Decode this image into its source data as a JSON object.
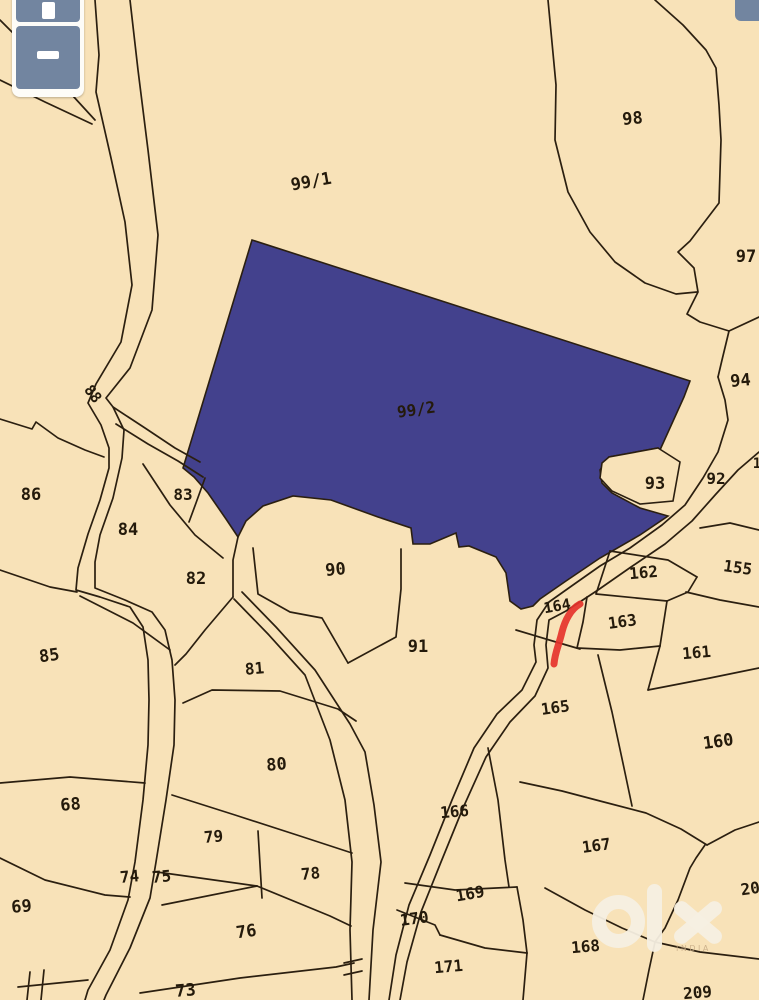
{
  "map": {
    "background_color": "#f8e2b8",
    "line_color": "#2b1f10",
    "highlight_parcel": {
      "label": "99/2",
      "fill": "#43418d",
      "label_color": "#23215f",
      "x": 417,
      "y": 415,
      "rotation": -8,
      "size": 16
    },
    "annotation": {
      "name": "red-marker-stroke",
      "color": "#e5332b"
    },
    "parcel_labels": [
      {
        "t": "98",
        "x": 633,
        "y": 124,
        "r": -5,
        "s": 17
      },
      {
        "t": "99/1",
        "x": 312,
        "y": 187,
        "r": -10,
        "s": 17
      },
      {
        "t": "97",
        "x": 746,
        "y": 262,
        "r": 0,
        "s": 17
      },
      {
        "t": "94",
        "x": 741,
        "y": 386,
        "r": -5,
        "s": 17
      },
      {
        "t": "92",
        "x": 716,
        "y": 484,
        "r": 0,
        "s": 16
      },
      {
        "t": "93",
        "x": 655,
        "y": 489,
        "r": 0,
        "s": 17
      },
      {
        "t": "1",
        "x": 757,
        "y": 468,
        "r": 0,
        "s": 14
      },
      {
        "t": "155",
        "x": 737,
        "y": 573,
        "r": 8,
        "s": 16
      },
      {
        "t": "86",
        "x": 31,
        "y": 500,
        "r": 0,
        "s": 17
      },
      {
        "t": "88",
        "x": 89,
        "y": 397,
        "r": 52,
        "s": 15
      },
      {
        "t": "83",
        "x": 183,
        "y": 500,
        "r": 0,
        "s": 16
      },
      {
        "t": "84",
        "x": 128,
        "y": 535,
        "r": 0,
        "s": 17
      },
      {
        "t": "82",
        "x": 196,
        "y": 584,
        "r": 0,
        "s": 17
      },
      {
        "t": "90",
        "x": 336,
        "y": 575,
        "r": -5,
        "s": 17
      },
      {
        "t": "85",
        "x": 50,
        "y": 661,
        "r": -8,
        "s": 17
      },
      {
        "t": "81",
        "x": 255,
        "y": 674,
        "r": -5,
        "s": 16
      },
      {
        "t": "91",
        "x": 418,
        "y": 652,
        "r": 0,
        "s": 17
      },
      {
        "t": "162",
        "x": 644,
        "y": 578,
        "r": -5,
        "s": 16
      },
      {
        "t": "164",
        "x": 558,
        "y": 611,
        "r": -10,
        "s": 15
      },
      {
        "t": "163",
        "x": 623,
        "y": 627,
        "r": -8,
        "s": 16
      },
      {
        "t": "161",
        "x": 697,
        "y": 658,
        "r": -5,
        "s": 16
      },
      {
        "t": "165",
        "x": 556,
        "y": 713,
        "r": -8,
        "s": 16
      },
      {
        "t": "160",
        "x": 719,
        "y": 747,
        "r": -8,
        "s": 17
      },
      {
        "t": "68",
        "x": 71,
        "y": 810,
        "r": -5,
        "s": 17
      },
      {
        "t": "80",
        "x": 277,
        "y": 770,
        "r": -5,
        "s": 17
      },
      {
        "t": "79",
        "x": 214,
        "y": 842,
        "r": -5,
        "s": 16
      },
      {
        "t": "78",
        "x": 311,
        "y": 879,
        "r": -5,
        "s": 16
      },
      {
        "t": "74",
        "x": 130,
        "y": 882,
        "r": -5,
        "s": 16
      },
      {
        "t": "75",
        "x": 162,
        "y": 882,
        "r": -5,
        "s": 16
      },
      {
        "t": "69",
        "x": 22,
        "y": 912,
        "r": -5,
        "s": 17
      },
      {
        "t": "76",
        "x": 247,
        "y": 937,
        "r": -8,
        "s": 17
      },
      {
        "t": "73",
        "x": 186,
        "y": 996,
        "r": -5,
        "s": 17
      },
      {
        "t": "166",
        "x": 455,
        "y": 817,
        "r": -5,
        "s": 16
      },
      {
        "t": "167",
        "x": 597,
        "y": 851,
        "r": -8,
        "s": 16
      },
      {
        "t": "169",
        "x": 471,
        "y": 899,
        "r": -10,
        "s": 16
      },
      {
        "t": "170",
        "x": 415,
        "y": 924,
        "r": -8,
        "s": 16
      },
      {
        "t": "168",
        "x": 586,
        "y": 952,
        "r": -5,
        "s": 16
      },
      {
        "t": "171",
        "x": 449,
        "y": 972,
        "r": -5,
        "s": 16
      },
      {
        "t": "209",
        "x": 698,
        "y": 998,
        "r": -5,
        "s": 16
      },
      {
        "t": "20",
        "x": 751,
        "y": 894,
        "r": -8,
        "s": 16
      }
    ]
  },
  "zoom_control": {
    "zoom_in_icon": "plus-icon",
    "zoom_out_icon": "minus-icon",
    "button_color": "#7285a0"
  },
  "corner_control": {
    "button_color": "#7285a0"
  },
  "watermark": {
    "logo": "olx-logo",
    "region_text": "INDIA",
    "logo_color": "#f6efe2",
    "text_color": "#c9ad87"
  }
}
